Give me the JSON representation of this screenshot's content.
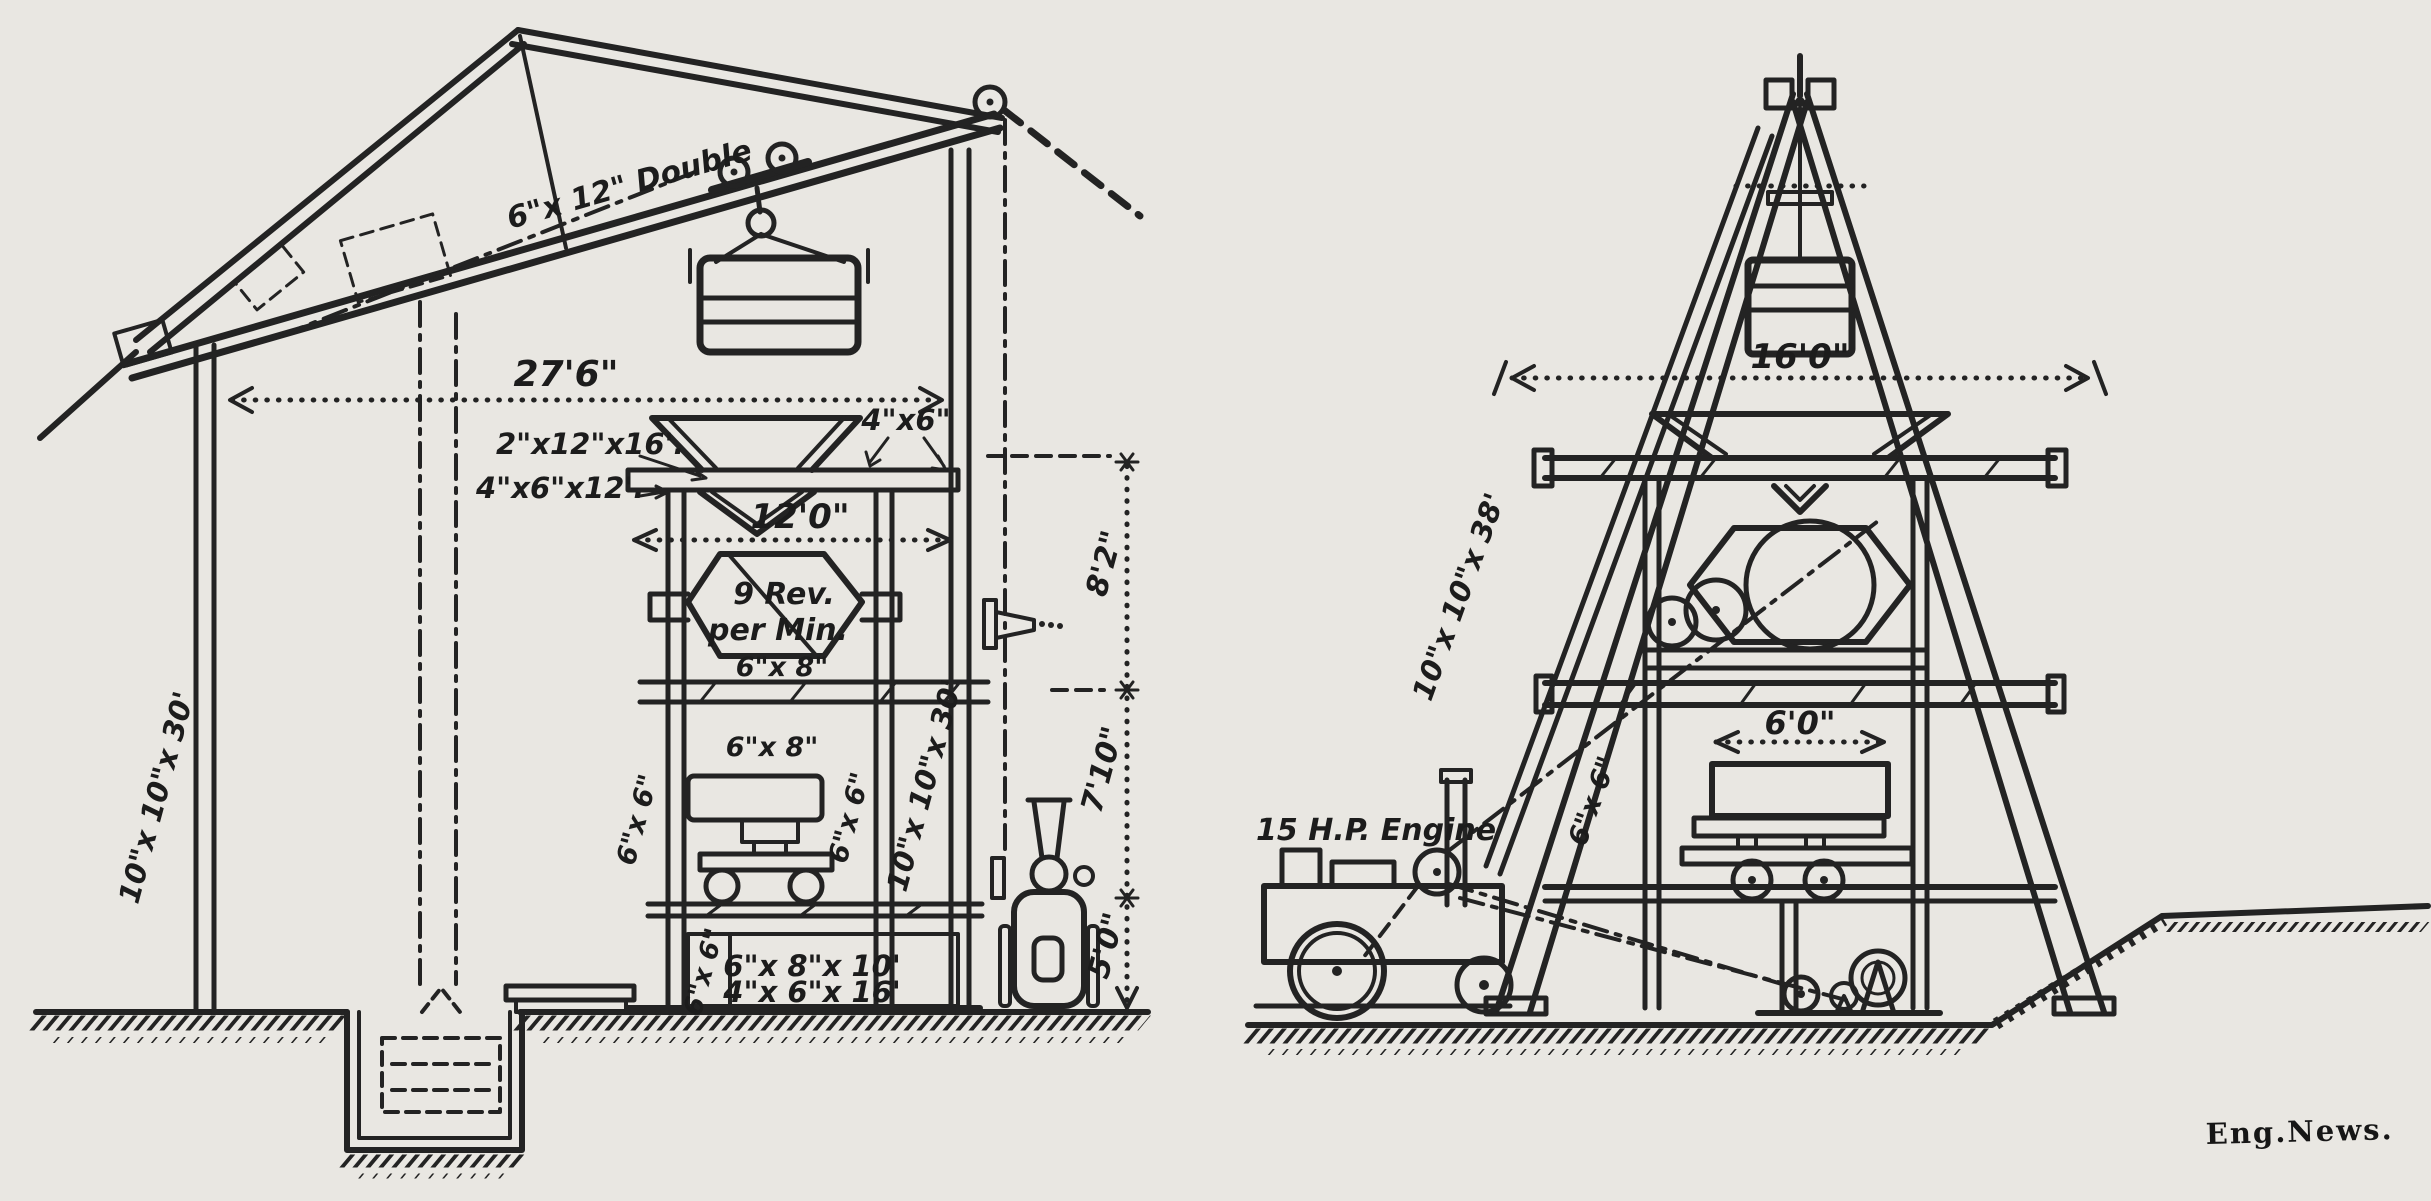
{
  "figure": {
    "credit": "Eng.News.",
    "paper_color": "#e9e7e2",
    "ink_color": "#232323",
    "description": "Two elevation drawings of a concrete mixing and hoisting plant: a housed mixer tower with inclined cableway (left) and an A-frame derrick tower with 15 H.P. engine (right)."
  },
  "left_view": {
    "track_label": "6\"x 12\" Double",
    "dim_width": "27'6\"",
    "callout_plank": "2\"x12\"x16'.",
    "callout_joist": "4\"x6\"x12'.",
    "callout_cap": "4\"x6\"",
    "dim_tower_width": "12'0\"",
    "mixer_line1": "9 Rev.",
    "mixer_line2": "per Min.",
    "shaft_label": "6\"x 8\"",
    "girt_label": "6\"x 8\"",
    "post_small_left": "6\"x 6\"",
    "post_small_right": "6\"x 6\"",
    "wall_post_left": "10\"x 10\"x 30'",
    "wall_post_right": "10\"x 10\"x 30'",
    "sill_line1": "6\"x 8\"x 10'",
    "sill_line2": "4\"x 6\"x 16'",
    "sill_small": "6\"x 6\"",
    "dim_upper": "8'2\"",
    "dim_middle": "7'10\"",
    "dim_lower": "5'0\""
  },
  "right_view": {
    "dim_width": "16'0\"",
    "leg_label": "10\"x 10\"x 38'",
    "dim_track": "6'0\"",
    "brace_label": "6\"x 6\"",
    "engine_label": "15 H.P. Engine"
  }
}
